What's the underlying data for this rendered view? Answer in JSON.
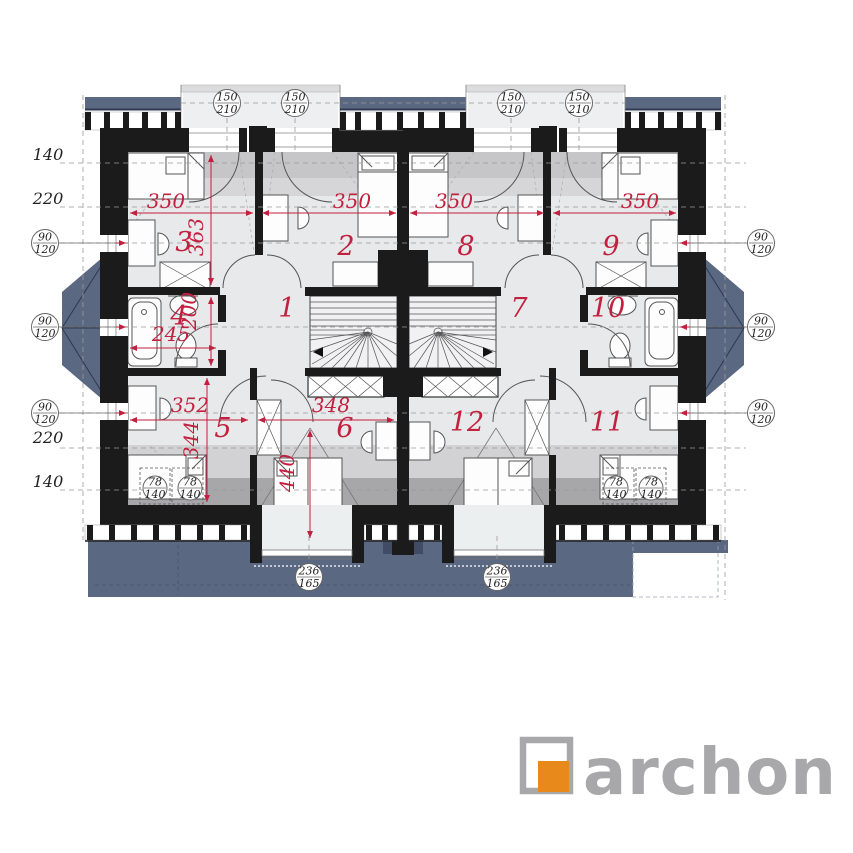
{
  "plan_title": "attic floor plan",
  "rooms": {
    "r1": "1",
    "r2": "2",
    "r3": "3",
    "r4": "4",
    "r5": "5",
    "r6": "6",
    "r7": "7",
    "r8": "8",
    "r9": "9",
    "r10": "10",
    "r11": "11",
    "r12": "12"
  },
  "dims_red": {
    "w350": "350",
    "h363": "363",
    "h200": "200",
    "w245": "245",
    "w352": "352",
    "h344": "344",
    "w348": "348",
    "h440": "440"
  },
  "dims_black": {
    "d140": "140",
    "d220": "220"
  },
  "tags": {
    "dormer_window": {
      "w": "150",
      "h": "210"
    },
    "side_window": {
      "w": "90",
      "h": "120"
    },
    "roof_window": {
      "w": "78",
      "h": "140"
    },
    "bottom_window": {
      "w": "236",
      "h": "165"
    }
  },
  "logo": {
    "brand": "archon"
  },
  "colors": {
    "roof_blue": "#5b6882",
    "wall_black": "#1b1b1b",
    "dim_red": "#c2203f",
    "logo_orange": "#e8891b",
    "logo_gray": "#a8a8aa"
  }
}
